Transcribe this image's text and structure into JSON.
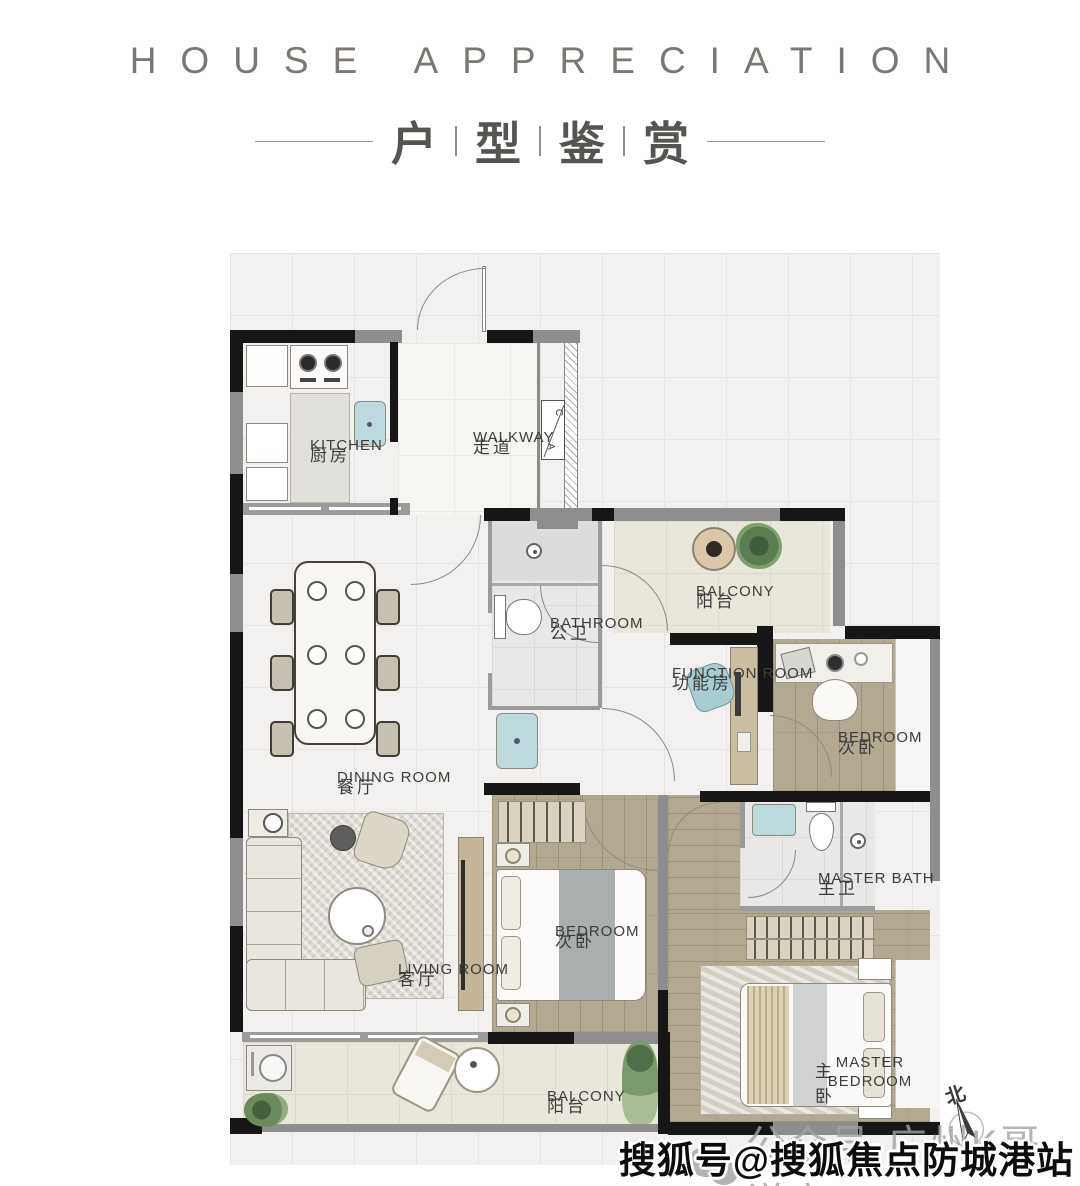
{
  "header": {
    "title_en": "HOUSE APPRECIATION",
    "title_cn_chars": [
      "户",
      "型",
      "鉴",
      "赏"
    ]
  },
  "rooms": {
    "kitchen": {
      "en": "KITCHEN",
      "cn": "厨房"
    },
    "walkway": {
      "en": "WALKWAY",
      "cn": "走道"
    },
    "bathroom": {
      "en": "BATHROOM",
      "cn": "公卫"
    },
    "balcony_top": {
      "en": "BALCONY",
      "cn": "阳台"
    },
    "function_room": {
      "en": "FUNCTION ROOM",
      "cn": "功能房"
    },
    "bedroom_right": {
      "en": "BEDROOM",
      "cn": "次卧"
    },
    "dining_room": {
      "en": "DINING ROOM",
      "cn": "餐厅"
    },
    "living_room": {
      "en": "LIVING ROOM",
      "cn": "客厅"
    },
    "bedroom_middle": {
      "en": "BEDROOM",
      "cn": "次卧"
    },
    "master_bath": {
      "en": "MASTER BATH",
      "cn": "主卫"
    },
    "master_bedroom": {
      "en": "MASTER BEDROOM",
      "cn": "主卧"
    },
    "balcony_bottom": {
      "en": "BALCONY",
      "cn": "阳台"
    }
  },
  "annotations": {
    "ac_letter_a": "A",
    "ac_letter_c": "C",
    "compass_north": "北"
  },
  "watermarks": {
    "wechat": "公众号·广州K哥说房",
    "sohu": "搜狐号@搜狐焦点防城港站"
  },
  "colors": {
    "wall_black": "#161616",
    "wall_gray": "#8e8e8e",
    "wood_floor": "#b3a892",
    "marble_floor": "#f2f1ef",
    "balcony_tile": "#e9e6dc",
    "teal_fixture": "#b7d6da",
    "title_gray": "#7b7873",
    "label_dark": "#3d3d3b"
  }
}
